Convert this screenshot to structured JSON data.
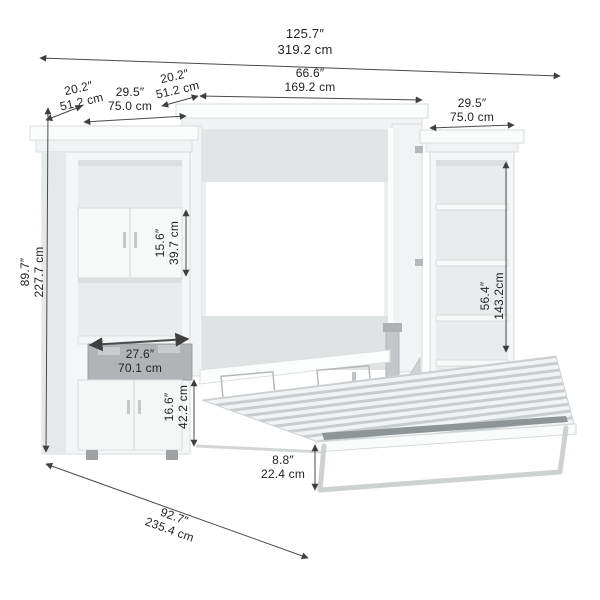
{
  "dimensions": {
    "overall_width": {
      "in": "125.7″",
      "cm": "319.2 cm"
    },
    "left_tower_depth": {
      "in": "20.2″",
      "cm": "51.2 cm"
    },
    "left_tower_width": {
      "in": "29.5″",
      "cm": "75.0 cm"
    },
    "bed_cabinet_depth": {
      "in": "20.2″",
      "cm": "51.2 cm"
    },
    "bed_cabinet_width": {
      "in": "66.6″",
      "cm": "169.2 cm"
    },
    "right_tower_width": {
      "in": "29.5″",
      "cm": "75.0 cm"
    },
    "overall_height": {
      "in": "89.7″",
      "cm": "227.7 cm"
    },
    "cabinet_height": {
      "in": "15.6″",
      "cm": "39.7 cm"
    },
    "shelf_section_height": {
      "in": "56.4″",
      "cm": "143.2cm"
    },
    "pullout_shelf_width": {
      "in": "27.6″",
      "cm": "70.1 cm"
    },
    "lower_cabinet_height": {
      "in": "16.6″",
      "cm": "42.2 cm"
    },
    "bed_frame_height": {
      "in": "8.8″",
      "cm": "22.4 cm"
    },
    "open_depth": {
      "in": "92.7″",
      "cm": "235.4 cm"
    }
  },
  "colors": {
    "background": "#ffffff",
    "furniture_light": "#f4f6f7",
    "furniture_shadow": "#e8ebec",
    "interior": "#eceff0",
    "back_panel": "#ffffff",
    "pullout_front": "#b0b4b6",
    "slat_gray": "#c9cdcf",
    "dimension_line": "#3f3f3f",
    "label_text": "#232323"
  }
}
